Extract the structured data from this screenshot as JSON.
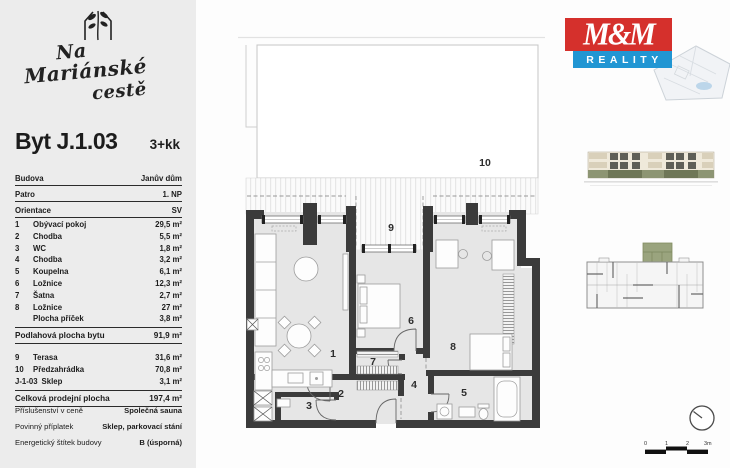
{
  "project": {
    "name_line1": "Na",
    "name_line2": "Mariánské",
    "name_line3": "cestě"
  },
  "unit": {
    "title": "Byt J.1.03",
    "disposition": "3+kk"
  },
  "info": [
    {
      "label": "Budova",
      "value": "Janův dům"
    },
    {
      "label": "Patro",
      "value": "1. NP"
    },
    {
      "label": "Orientace",
      "value": "SV"
    }
  ],
  "rooms": [
    {
      "num": "1",
      "name": "Obývací pokoj",
      "area": "29,5 m²"
    },
    {
      "num": "2",
      "name": "Chodba",
      "area": "5,5 m²"
    },
    {
      "num": "3",
      "name": "WC",
      "area": "1,8 m²"
    },
    {
      "num": "4",
      "name": "Chodba",
      "area": "3,2 m²"
    },
    {
      "num": "5",
      "name": "Koupelna",
      "area": "6,1 m²"
    },
    {
      "num": "6",
      "name": "Ložnice",
      "area": "12,3 m²"
    },
    {
      "num": "7",
      "name": "Šatna",
      "area": "2,7 m²"
    },
    {
      "num": "8",
      "name": "Ložnice",
      "area": "27 m²"
    },
    {
      "num": "",
      "name": "Plocha příček",
      "area": "3,8 m²"
    }
  ],
  "subtotal": {
    "label": "Podlahová plocha bytu",
    "value": "91,9 m²"
  },
  "outdoor": [
    {
      "num": "9",
      "name": "Terasa",
      "area": "31,6 m²"
    },
    {
      "num": "10",
      "name": "Předzahrádka",
      "area": "70,8 m²"
    },
    {
      "num": "J-1-03",
      "name": "Sklep",
      "area": "3,1 m²"
    }
  ],
  "total": {
    "label": "Celková prodejní plocha",
    "value": "197,4 m²"
  },
  "details": [
    {
      "label": "Příslušenství v ceně",
      "value": "Společná sauna"
    },
    {
      "label": "Povinný příplatek",
      "value": "Sklep, parkovací stání"
    },
    {
      "label": "Energetický štítek budovy",
      "value": "B (úsporná)"
    }
  ],
  "plan": {
    "labels": [
      "1",
      "2",
      "3",
      "4",
      "5",
      "6",
      "7",
      "8",
      "9",
      "10"
    ]
  },
  "branding": {
    "logo_top": "M&M",
    "logo_bottom": "REALITY"
  },
  "scalebar": {
    "ticks": [
      "0",
      "1",
      "2",
      "3m"
    ]
  },
  "colors": {
    "logo_red": "#d5302c",
    "logo_blue": "#2196d3",
    "wall": "#3b3b3b",
    "floor": "#e6e6e6",
    "unit_highlight": "#9aa47e",
    "sidebar_bg": "#ececec",
    "elevation_base": "#8d9573"
  }
}
